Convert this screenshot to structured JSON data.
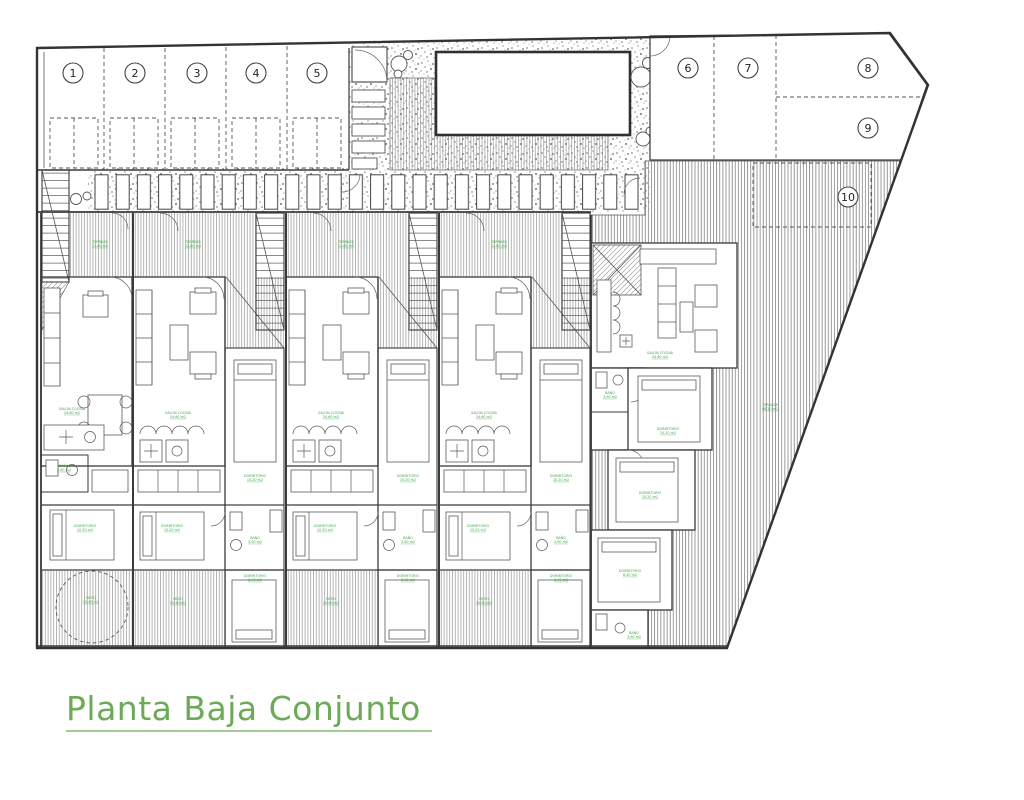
{
  "drawing": {
    "title": "Planta Baja Conjunto",
    "plot_numbers": [
      "1",
      "2",
      "3",
      "4",
      "5",
      "6",
      "7",
      "8",
      "9",
      "10"
    ],
    "labels": {
      "terraza": {
        "name": "TERRAZA",
        "area": "12.80 m2"
      },
      "salon": {
        "name": "SALON-COCINA",
        "area": "24.60 m2"
      },
      "dormitorio": {
        "name": "DORMITORIO",
        "area": "10.20 m2"
      },
      "dormitorio2": {
        "name": "DORMITORIO",
        "area": "8.40 m2"
      },
      "bano": {
        "name": "BAÑO",
        "area": "3.90 m2"
      },
      "patio": {
        "name": "PATIO",
        "area": "15.40 m2"
      },
      "terraza10": {
        "name": "TERRAZA",
        "area": "98.20 m2"
      }
    },
    "colors": {
      "accent_green": "#6caa58",
      "label_green": "#44a64c",
      "line": "#3a3a3a"
    }
  }
}
